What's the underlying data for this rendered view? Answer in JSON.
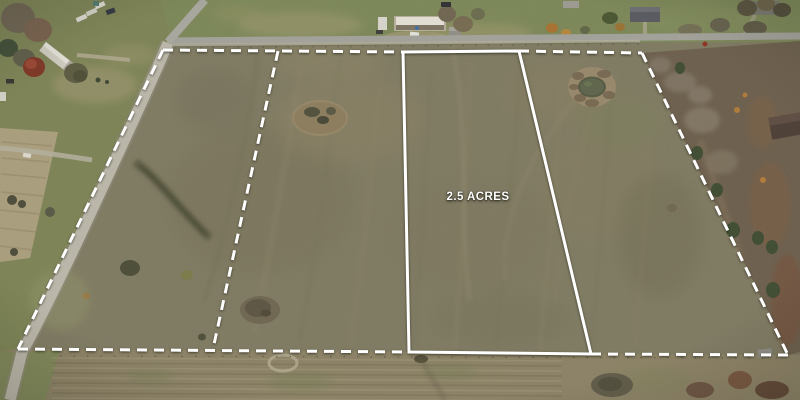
{
  "image_description": "Aerial drone photograph of flat winter pasture marked with white surveyed lot lines: a featured parcel outlined in solid white labeled 2.5 ACRES, dashed outer boundary and one dashed divider line, gravel road on the left, paved road with farmstead buildings along the top, a round stock pond, dirt mounds in the field, and bare winter brush along the right side",
  "overlay": {
    "parcel_label": "2.5 ACRES",
    "line_color": "#ffffff",
    "boundaries": {
      "outer_left": "163,50 18,349",
      "outer_top_left": "163,50 403,52",
      "outer_top_right": "519,51 642,53",
      "outer_right": "642,53 788,355",
      "outer_bottom_left": "18,349 409,352",
      "outer_bottom_right": "591,354 788,355",
      "divider": "278,51 213,349",
      "featured_parcel": "403,52 519,51 591,354 409,352"
    }
  },
  "scene": {
    "colors": {
      "pasture": "#7e7961",
      "lawn_north": "#7b8757",
      "lawn_west": "#7c8354",
      "tan_field": "#aa9e7c",
      "south_field": "#8b8165",
      "paved_road": "#a2a29b",
      "gravel_road": "#bcb8ab",
      "brush_east": "#6b5d4b",
      "pond_ring": "#97876a",
      "pond_water": "#5c644a",
      "tree_red": "#7e3322",
      "barn_roof": "#e6e2d8"
    }
  }
}
